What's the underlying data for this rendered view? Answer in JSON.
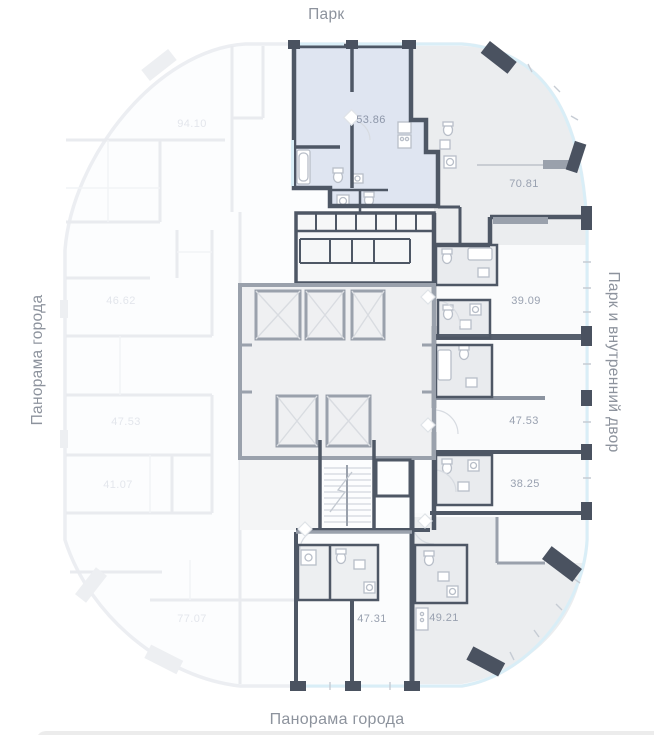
{
  "surroundings": {
    "top": "Парк",
    "left": "Панорама города",
    "right": "Парк и внутренний двор",
    "bottom": "Панорама города"
  },
  "apartments": [
    {
      "area": "53.86",
      "highlighted": true
    },
    {
      "area": "70.81",
      "highlighted": false
    },
    {
      "area": "39.09",
      "highlighted": false
    },
    {
      "area": "47.53",
      "highlighted": false
    },
    {
      "area": "38.25",
      "highlighted": false
    },
    {
      "area": "49.21",
      "highlighted": false
    },
    {
      "area": "47.31",
      "highlighted": false
    }
  ],
  "faded_apartments": [
    {
      "area": "94.10"
    },
    {
      "area": "46.62"
    },
    {
      "area": "47.53"
    },
    {
      "area": "41.07"
    },
    {
      "area": "77.07"
    }
  ],
  "colors": {
    "highlight_fill": "#dfe5f1",
    "room_fill": "#ebedef",
    "wall_dark": "#4e5765",
    "wall_core": "#9aa1ac",
    "glass_blue": "#d9eef7",
    "area_text": "#99a1b0",
    "label_text": "#8d939d"
  }
}
